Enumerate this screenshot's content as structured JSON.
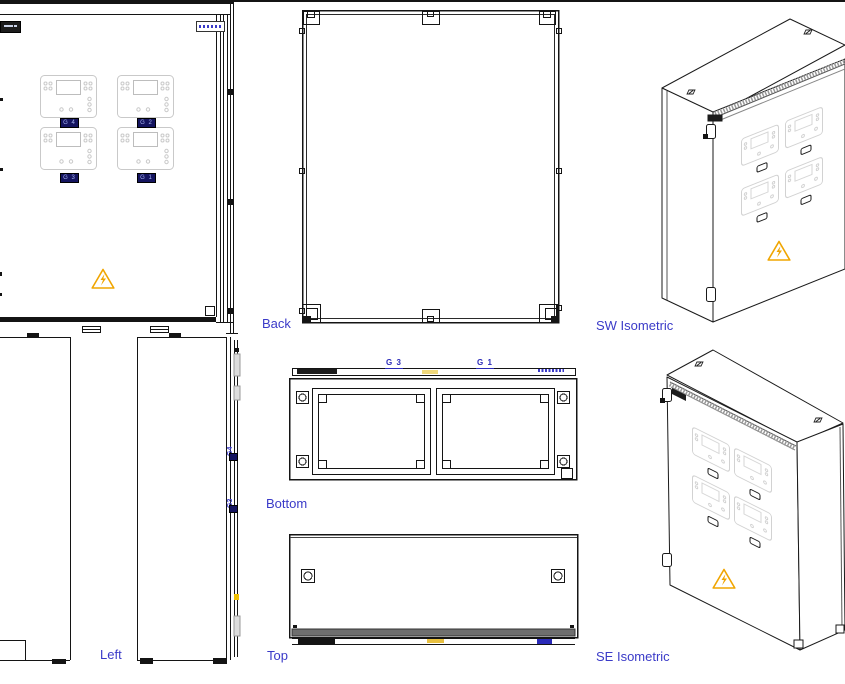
{
  "drawing": {
    "labels": {
      "back": "Back",
      "sw_iso": "SW Isometric",
      "left": "Left",
      "bottom": "Bottom",
      "top": "Top",
      "se_iso": "SE Isometric"
    },
    "front_badges": {
      "g4": "G 4",
      "g2": "G 2",
      "g3": "G 3",
      "g1": "G 1"
    },
    "bottom_labels": {
      "g3": "G 3",
      "g1": "G 1"
    },
    "left_edge_labels": {
      "g4": "G4",
      "g3": "G3"
    },
    "icons": {
      "warning": "high-voltage-warning-icon",
      "fastener": "bolt-fastener-icon"
    },
    "colors": {
      "label_blue": "#3A3AC8",
      "badge_navy": "#14145F",
      "warning_yellow": "#F0A500",
      "line_black": "#1A1A1A",
      "faint_gray": "#D2D2D2"
    }
  }
}
